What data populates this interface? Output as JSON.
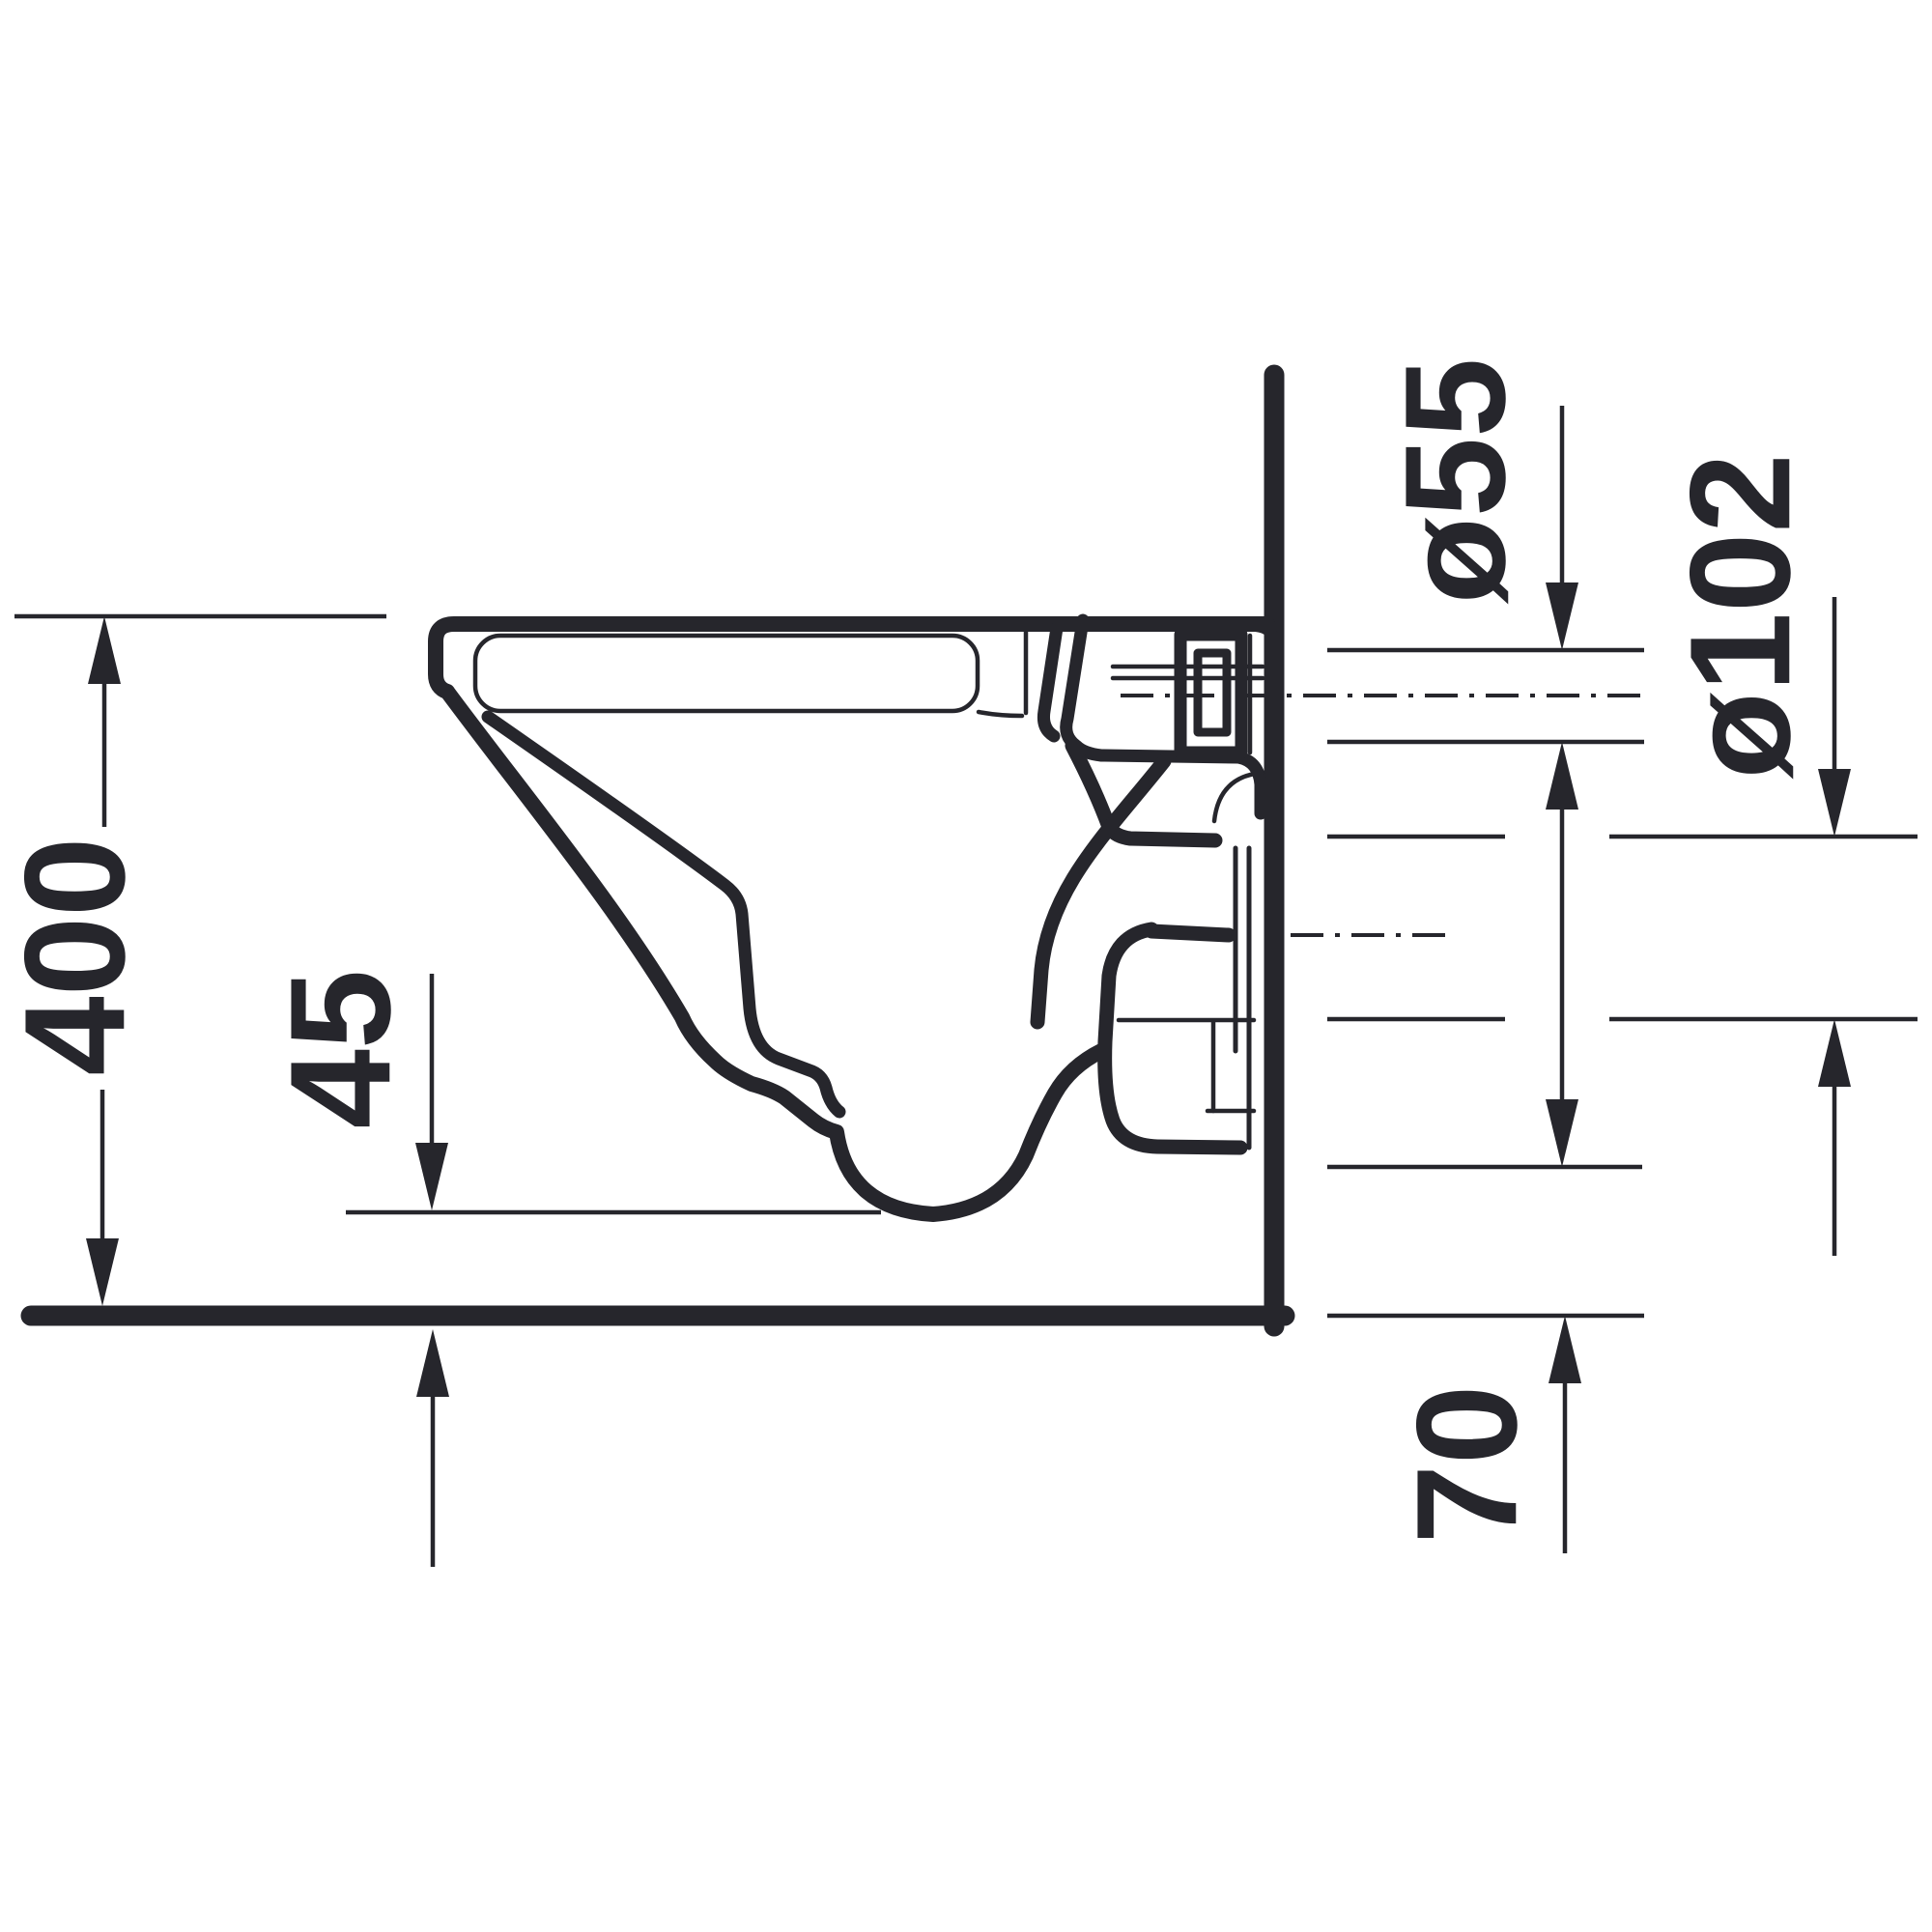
{
  "meta": {
    "type": "technical-drawing",
    "subject": "wall-hung toilet side elevation with installation dimensions"
  },
  "colors": {
    "ink": "#26262c",
    "background": "#ffffff"
  },
  "labels": {
    "height_overall": "400",
    "front_edge_offset": "45",
    "flush_pipe_diameter": "ø55",
    "outlet_pipe_diameter": "ø102",
    "outlet_bottom_height": "70"
  }
}
